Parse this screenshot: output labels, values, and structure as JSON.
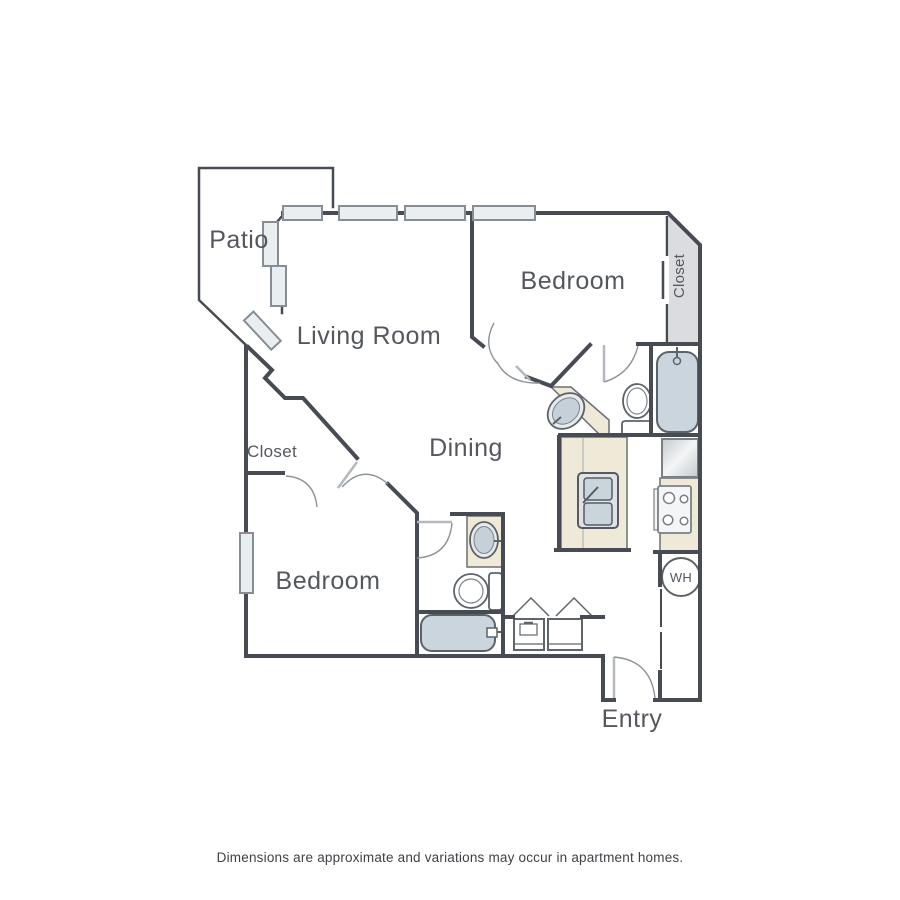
{
  "rooms": {
    "patio": "Patio",
    "living_room": "Living Room",
    "dining": "Dining",
    "bedroom_top": "Bedroom",
    "bedroom_bottom": "Bedroom",
    "entry": "Entry"
  },
  "closets": {
    "left": "Closet",
    "right": "Closet"
  },
  "appliances": {
    "water_heater_label": "WH"
  },
  "disclaimer": "Dimensions are approximate and variations may occur in apartment homes.",
  "fixtures": [
    "bathtub",
    "toilet",
    "vanity-sink",
    "kitchen-double-sink",
    "stove",
    "refrigerator",
    "washer",
    "dryer",
    "water-heater",
    "window",
    "door-swing",
    "sliding-closet-door"
  ],
  "colors": {
    "wall": "#474b54",
    "window_fill": "#e9eef1",
    "counter": "#efe9d8",
    "fixture_fill": "#cbd5dd",
    "closet_shade": "#dadce0",
    "door_arc": "#8d939a"
  }
}
